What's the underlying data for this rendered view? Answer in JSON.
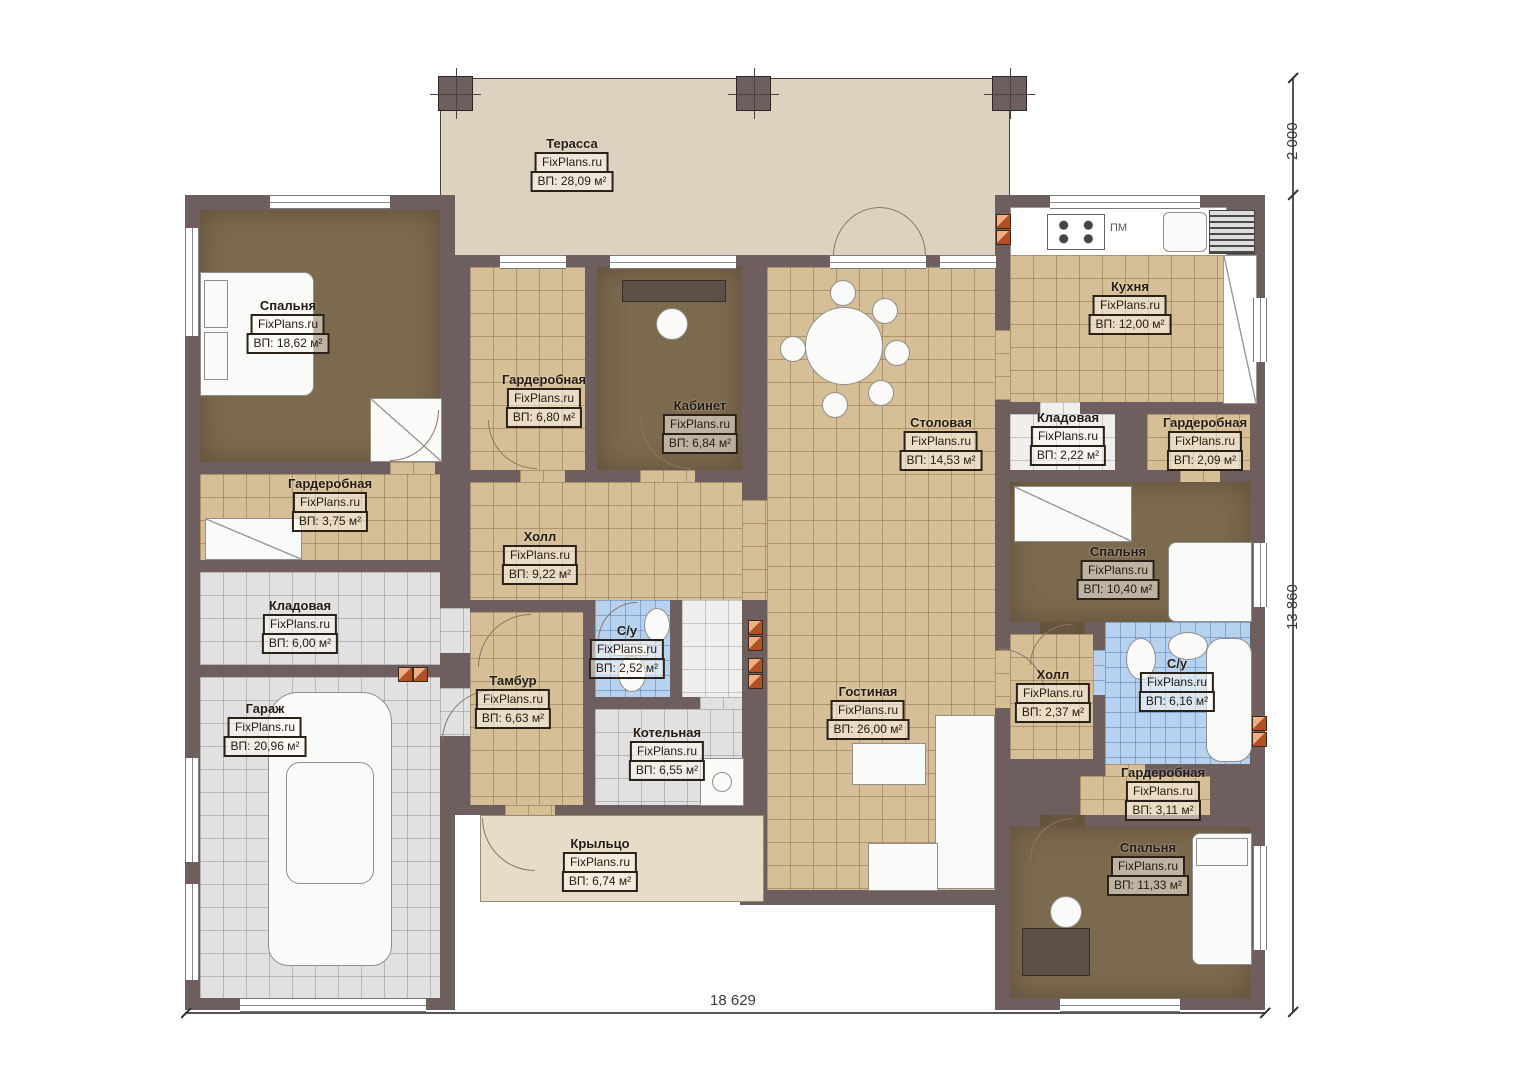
{
  "watermark": "FixPlans.ru",
  "rooms": [
    {
      "name": "Терасса",
      "area": "ВП: 28,09 м²"
    },
    {
      "name": "Спальня",
      "area": "ВП: 18,62 м²"
    },
    {
      "name": "Гардеробная",
      "area": "ВП: 6,80 м²"
    },
    {
      "name": "Кабинет",
      "area": "ВП: 6,84 м²"
    },
    {
      "name": "Столовая",
      "area": "ВП: 14,53 м²"
    },
    {
      "name": "Кухня",
      "area": "ВП: 12,00 м²"
    },
    {
      "name": "Кладовая",
      "area": "ВП: 2,22 м²"
    },
    {
      "name": "Гардеробная",
      "area": "ВП: 2,09 м²"
    },
    {
      "name": "Гардеробная",
      "area": "ВП: 3,75 м²"
    },
    {
      "name": "Холл",
      "area": "ВП: 9,22 м²"
    },
    {
      "name": "Спальня",
      "area": "ВП: 10,40 м²"
    },
    {
      "name": "Кладовая",
      "area": "ВП: 6,00 м²"
    },
    {
      "name": "Гараж",
      "area": "ВП: 20,96 м²"
    },
    {
      "name": "Тамбур",
      "area": "ВП: 6,63 м²"
    },
    {
      "name": "С/у",
      "area": "ВП: 2,52 м²"
    },
    {
      "name": "Котельная",
      "area": "ВП: 6,55 м²"
    },
    {
      "name": "Гостиная",
      "area": "ВП: 26,00 м²"
    },
    {
      "name": "Холл",
      "area": "ВП: 2,37 м²"
    },
    {
      "name": "С/у",
      "area": "ВП: 6,16 м²"
    },
    {
      "name": "Гардеробная",
      "area": "ВП: 3,11 м²"
    },
    {
      "name": "Спальня",
      "area": "ВП: 11,33 м²"
    },
    {
      "name": "Крыльцо",
      "area": "ВП: 6,74 м²"
    }
  ],
  "kitchen": {
    "dishwasher_label": "ПМ"
  },
  "dimensions": {
    "overall_width": "18 629",
    "overall_height": "13 860",
    "terrace_depth": "2 000"
  },
  "colors": {
    "wall": "#6e5e5e",
    "tile_tan": "#d6bf97",
    "tile_gray": "#e1e1e1",
    "tile_blue": "#b7d2ee",
    "carpet": "#7c6a4f",
    "terrace": "#ddd2bf",
    "vent": "#b05024"
  }
}
